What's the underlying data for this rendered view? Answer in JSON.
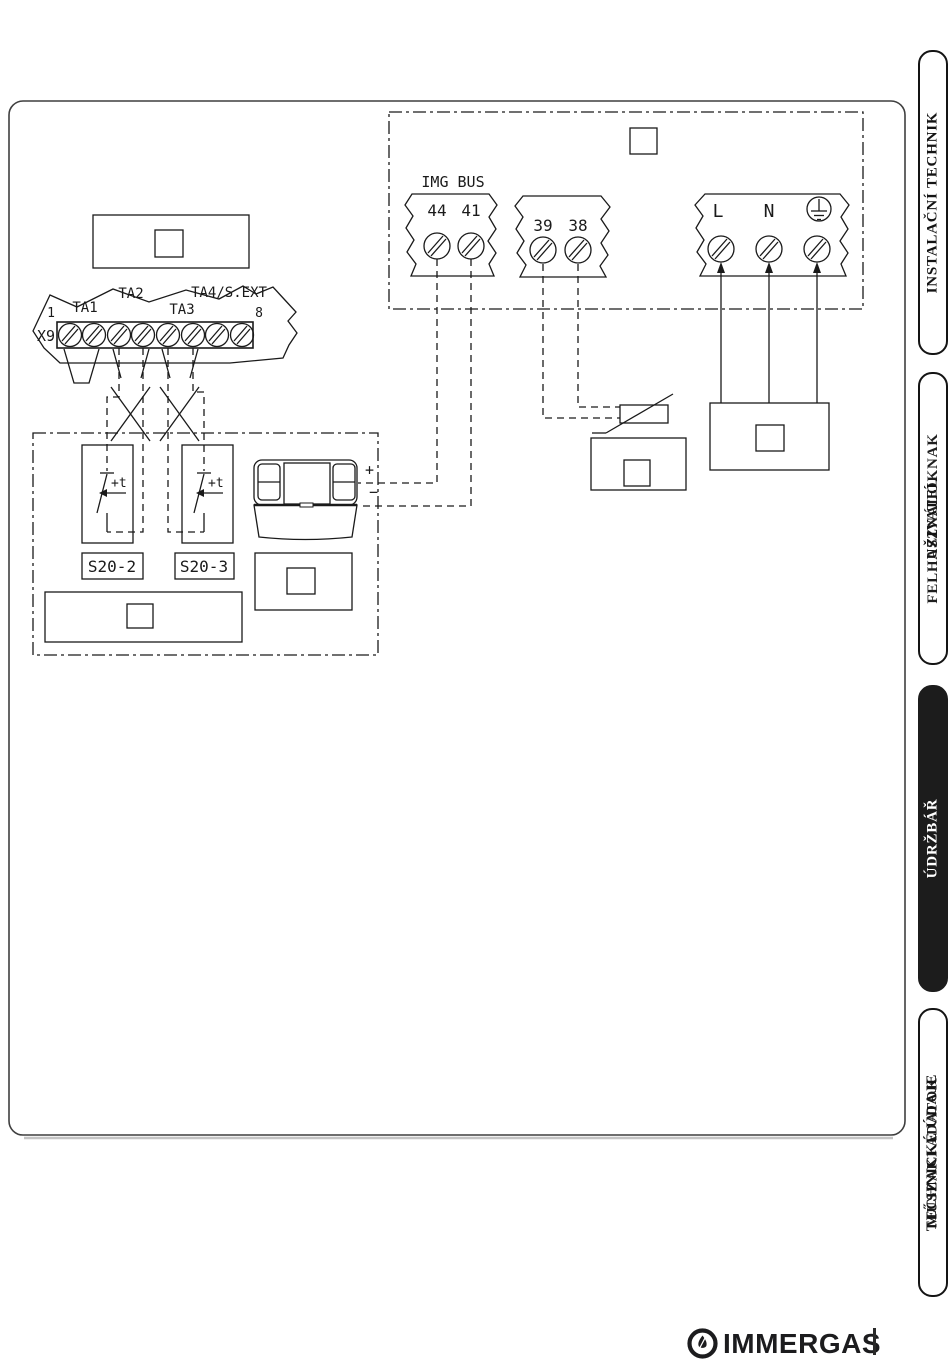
{
  "colors": {
    "ink": "#1a1a1a",
    "tab_solid_bg": "#1c1c1c",
    "tab_solid_text": "#ffffff",
    "brand": "#1c1c1e"
  },
  "diagram": {
    "boiler_block": {
      "bus_label": "IMG BUS",
      "terminal_44": "44",
      "terminal_41": "41",
      "terminal_39": "39",
      "terminal_38": "38",
      "line_label": "L",
      "neutral_label": "N"
    },
    "x9_connector": {
      "connector_label": "X9",
      "pin_first": "1",
      "pin_last": "8",
      "ta1": "TA1",
      "ta2": "TA2",
      "ta3": "TA3",
      "ta4_sext": "TA4/S.EXT"
    },
    "external_units": {
      "s20_2": "S20-2",
      "s20_3": "S20-3",
      "thermostat_contact": "+t",
      "car_plus": "+",
      "car_minus": "−"
    }
  },
  "sidebar": {
    "tabs": [
      {
        "label": "INSTALAČNÍ TECHNIK",
        "overlay": ""
      },
      {
        "label": "UŽIVATEL",
        "overlay": "FELHASZNÁLÓKNAK"
      },
      {
        "label": "ÚDRŽBÁŘ",
        "overlay": ""
      },
      {
        "label": "TECHNICKÉ ÚDAJE",
        "overlay": "MŰSZAKI ADATOK"
      }
    ]
  },
  "footer": {
    "brand": "IMMERGAS"
  }
}
